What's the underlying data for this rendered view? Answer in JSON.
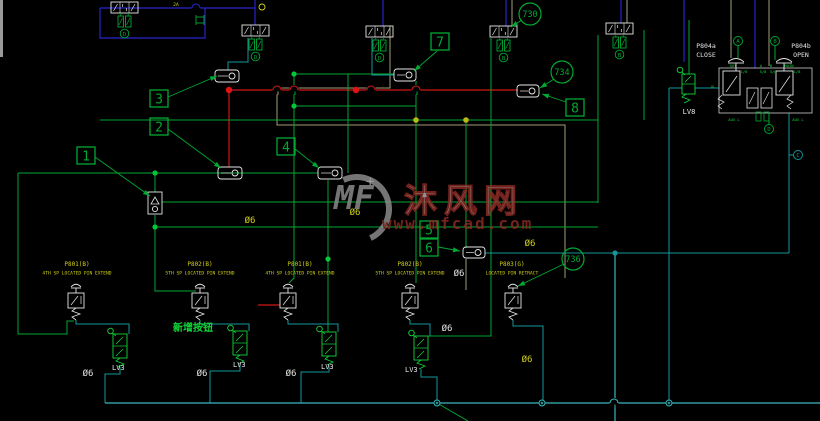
{
  "app": {
    "type": "cad-pneumatic-schematic",
    "background": "#000000"
  },
  "watermark": {
    "logo_text": "MF",
    "plus": "+",
    "site_name": "沐风网",
    "site_url": "www.mfcad.com"
  },
  "colors": {
    "green": "#00a833",
    "bright_green": "#12d63a",
    "teal": "#13969c",
    "cyan": "#38b8be",
    "blue": "#2626cc",
    "red": "#cf1616",
    "tan": "#a39d78",
    "yellow": "#d2d21a",
    "white": "#e6e6e6",
    "grey": "#9a9a9a",
    "maroon": "#8e2a22",
    "olive": "#b8b814"
  },
  "diagram": {
    "valves53": [
      {
        "cx": 124.5,
        "top": 2,
        "letter": "D"
      },
      {
        "cx": 255.5,
        "top": 25,
        "letter": "D"
      },
      {
        "cx": 379.5,
        "top": 26,
        "letter": "D"
      },
      {
        "cx": 503.5,
        "top": 26,
        "letter": "B"
      },
      {
        "cx": 619.5,
        "top": 23,
        "letter": "B"
      }
    ],
    "pushbuttons": [
      {
        "cx": 76
      },
      {
        "cx": 200
      },
      {
        "cx": 288
      },
      {
        "cx": 410
      },
      {
        "cx": 513
      }
    ],
    "lv_valves": [
      {
        "cx": 120,
        "top": 334,
        "label": "LV3",
        "lx": 112,
        "ly": 370
      },
      {
        "cx": 240,
        "top": 331,
        "label": "LV3",
        "lx": 233,
        "ly": 367
      },
      {
        "cx": 329,
        "top": 332,
        "label": "LV3",
        "lx": 321,
        "ly": 369
      },
      {
        "cx": 421,
        "top": 336,
        "label": "LV3",
        "lx": 405,
        "ly": 372
      }
    ],
    "lv8": {
      "x": 682,
      "y": 74,
      "label": "LV8",
      "lx": 682,
      "ly": 114
    },
    "check_valve": {
      "x": 148,
      "y": 192
    },
    "inline_components": [
      {
        "x": 215,
        "y": 70,
        "w": 24,
        "h": 12
      },
      {
        "x": 218,
        "y": 167,
        "w": 24,
        "h": 12
      },
      {
        "x": 318,
        "y": 167,
        "w": 24,
        "h": 12
      },
      {
        "x": 394,
        "y": 69,
        "w": 22,
        "h": 12
      },
      {
        "x": 517,
        "y": 85,
        "w": 22,
        "h": 12
      },
      {
        "x": 463,
        "y": 247,
        "w": 22,
        "h": 11
      }
    ],
    "assembly": {
      "rect": [
        719,
        68,
        93,
        45
      ],
      "left_code": "P804a",
      "left_state": "CLOSE",
      "right_code": "P804b",
      "right_state": "OPEN",
      "code_left_x": 706,
      "code_right_x": 801,
      "port_labels": [
        {
          "t": "OUT",
          "x": 733,
          "y": 67
        },
        {
          "t": "A",
          "x": 761,
          "y": 67
        },
        {
          "t": "B",
          "x": 771,
          "y": 67
        },
        {
          "t": "MAIN",
          "x": 789,
          "y": 67
        },
        {
          "t": "1/8",
          "x": 744,
          "y": 73
        },
        {
          "t": "5/8",
          "x": 763,
          "y": 73
        },
        {
          "t": "3/8",
          "x": 773,
          "y": 73
        },
        {
          "t": "1/8",
          "x": 797,
          "y": 73
        },
        {
          "t": "GL",
          "x": 713,
          "y": 88
        },
        {
          "t": "AUX L",
          "x": 734,
          "y": 121
        },
        {
          "t": "AUX L",
          "x": 798,
          "y": 121
        }
      ]
    },
    "port_circles": [
      {
        "letter": "A",
        "x": 738,
        "y": 41,
        "c": "green"
      },
      {
        "letter": "B",
        "x": 775,
        "y": 41,
        "c": "green"
      },
      {
        "letter": "D",
        "x": 769,
        "y": 129,
        "c": "green"
      },
      {
        "letter": "C",
        "x": 798,
        "y": 155,
        "c": "teal"
      }
    ],
    "stations": [
      {
        "code": "P801(B)",
        "desc": "4TH SP LOCATED PIN EXTEND",
        "x": 77
      },
      {
        "code": "P802(B)",
        "desc": "5TH SP LOCATED PIN EXTEND",
        "x": 200
      },
      {
        "code": "P801(B)",
        "desc": "4TH SP LOCATED PIN EXTEND",
        "x": 300
      },
      {
        "code": "P802(B)",
        "desc": "5TH SP LOCATED PIN EXTEND",
        "x": 410
      },
      {
        "code": "P803(G)",
        "desc": "LOCATED PIN RETRACT",
        "x": 512
      }
    ],
    "note": {
      "text": "新增按钮",
      "x": 193,
      "y": 331
    },
    "tiny_texts": [
      {
        "t": "2A",
        "x": 176,
        "y": 6
      }
    ],
    "diam_labels": [
      {
        "t": "Ø6",
        "x": 250,
        "y": 223,
        "c": "yellow"
      },
      {
        "t": "Ø6",
        "x": 355,
        "y": 215,
        "c": "yellow"
      },
      {
        "t": "Ø6",
        "x": 530,
        "y": 246,
        "c": "yellow"
      },
      {
        "t": "Ø6",
        "x": 527,
        "y": 362,
        "c": "yellow"
      },
      {
        "t": "Ø6",
        "x": 459,
        "y": 276,
        "c": "white"
      },
      {
        "t": "Ø6",
        "x": 88,
        "y": 376,
        "c": "white"
      },
      {
        "t": "Ø6",
        "x": 202,
        "y": 376,
        "c": "white"
      },
      {
        "t": "Ø6",
        "x": 291,
        "y": 376,
        "c": "white"
      },
      {
        "t": "Ø6",
        "x": 447,
        "y": 331,
        "c": "white"
      }
    ],
    "callout_squares": [
      {
        "n": "1",
        "x": 77,
        "y": 147,
        "lead": [
          [
            95,
            157
          ],
          [
            150,
            196
          ]
        ]
      },
      {
        "n": "2",
        "x": 150,
        "y": 118,
        "lead": [
          [
            168,
            129
          ],
          [
            221,
            168
          ]
        ]
      },
      {
        "n": "3",
        "x": 150,
        "y": 90,
        "lead": [
          [
            168,
            97
          ],
          [
            217,
            76
          ]
        ]
      },
      {
        "n": "4",
        "x": 277,
        "y": 138,
        "lead": [
          [
            295,
            149
          ],
          [
            319,
            168
          ]
        ]
      },
      {
        "n": "5",
        "x": 420,
        "y": 221,
        "lead": null
      },
      {
        "n": "6",
        "x": 420,
        "y": 239,
        "lead": [
          [
            438,
            247
          ],
          [
            460,
            251
          ]
        ]
      },
      {
        "n": "7",
        "x": 431,
        "y": 33,
        "lead": [
          [
            437,
            51
          ],
          [
            414,
            71
          ]
        ]
      },
      {
        "n": "8",
        "x": 566,
        "y": 99,
        "lead": [
          [
            566,
            102
          ],
          [
            542,
            94
          ]
        ]
      }
    ],
    "callout_circles": [
      {
        "n": "730",
        "x": 530,
        "y": 14,
        "lead": [
          [
            522,
            20
          ],
          [
            511,
            27
          ]
        ]
      },
      {
        "n": "734",
        "x": 562,
        "y": 72,
        "lead": [
          [
            554,
            79
          ],
          [
            540,
            88
          ]
        ]
      },
      {
        "n": "736",
        "x": 573,
        "y": 259,
        "lead": [
          [
            564,
            264
          ],
          [
            518,
            286
          ]
        ]
      }
    ],
    "wires": {
      "tan": [
        [
          [
            390,
            26
          ],
          [
            390,
            88
          ],
          [
            277,
            88
          ],
          [
            277,
            125
          ],
          [
            565,
            125
          ],
          [
            565,
            278
          ]
        ],
        [
          [
            512,
            0
          ],
          [
            512,
            26
          ]
        ],
        [
          [
            627,
            0
          ],
          [
            627,
            23
          ]
        ],
        [
          [
            731,
            0
          ],
          [
            731,
            58
          ]
        ],
        [
          [
            769,
            0
          ],
          [
            769,
            66
          ]
        ],
        [
          [
            466,
            259
          ],
          [
            466,
            290
          ]
        ]
      ],
      "blue": [
        [
          [
            100,
            8
          ],
          [
            100,
            38
          ],
          [
            205,
            38
          ],
          [
            205,
            8
          ]
        ],
        [
          [
            100,
            8
          ],
          [
            255,
            8
          ]
        ],
        [
          [
            255,
            0
          ],
          [
            255,
            25
          ]
        ],
        [
          [
            383,
            0
          ],
          [
            383,
            26
          ]
        ],
        [
          [
            506,
            0
          ],
          [
            506,
            26
          ]
        ],
        [
          [
            621,
            0
          ],
          [
            621,
            23
          ]
        ],
        [
          [
            684,
            0
          ],
          [
            684,
            62
          ]
        ],
        [
          [
            755,
            0
          ],
          [
            755,
            68
          ]
        ]
      ],
      "red": [
        [
          [
            229,
            90
          ],
          [
            229,
            167
          ]
        ],
        [
          [
            229,
            90
          ],
          [
            518,
            90
          ]
        ],
        [
          [
            258,
            305
          ],
          [
            280,
            305
          ]
        ]
      ],
      "green": [
        [
          [
            294,
            74
          ],
          [
            294,
            278
          ],
          [
            289,
            283
          ]
        ],
        [
          [
            348,
            74
          ],
          [
            348,
            173
          ]
        ],
        [
          [
            416,
            81
          ],
          [
            416,
            283
          ]
        ],
        [
          [
            466,
            120
          ],
          [
            466,
            248
          ]
        ],
        [
          [
            491,
            38
          ],
          [
            491,
            336
          ],
          [
            428,
            336
          ]
        ],
        [
          [
            328,
            180
          ],
          [
            328,
            332
          ]
        ],
        [
          [
            294,
            74
          ],
          [
            394,
            74
          ]
        ],
        [
          [
            294,
            106
          ],
          [
            416,
            106
          ]
        ],
        [
          [
            100,
            120
          ],
          [
            598,
            120
          ]
        ],
        [
          [
            18,
            173
          ],
          [
            318,
            173
          ]
        ],
        [
          [
            162,
            202
          ],
          [
            598,
            202
          ]
        ],
        [
          [
            155,
            227
          ],
          [
            598,
            227
          ]
        ],
        [
          [
            155,
            173
          ],
          [
            155,
            192
          ]
        ],
        [
          [
            155,
            215
          ],
          [
            155,
            291
          ],
          [
            196,
            291
          ]
        ],
        [
          [
            18,
            173
          ],
          [
            18,
            334
          ],
          [
            67,
            334
          ],
          [
            67,
            321
          ],
          [
            74,
            321
          ]
        ],
        [
          [
            598,
            35
          ],
          [
            598,
            203
          ]
        ],
        [
          [
            644,
            30
          ],
          [
            644,
            120
          ]
        ],
        [
          [
            689,
            20
          ],
          [
            689,
            74
          ]
        ],
        [
          [
            437,
            403
          ],
          [
            468,
            421
          ]
        ],
        [
          [
            738,
            45
          ],
          [
            738,
            58
          ]
        ],
        [
          [
            775,
            45
          ],
          [
            775,
            60
          ]
        ],
        [
          [
            769,
            124
          ],
          [
            769,
            113
          ]
        ]
      ],
      "teal": [
        [
          [
            248,
            38
          ],
          [
            248,
            62
          ],
          [
            228,
            62
          ],
          [
            228,
            70
          ]
        ],
        [
          [
            372,
            38
          ],
          [
            372,
            75
          ],
          [
            394,
            75
          ]
        ],
        [
          [
            669,
            88
          ],
          [
            682,
            88
          ]
        ],
        [
          [
            695,
            88
          ],
          [
            719,
            88
          ]
        ],
        [
          [
            669,
            88
          ],
          [
            669,
            403
          ]
        ],
        [
          [
            789,
            113
          ],
          [
            789,
            253
          ]
        ],
        [
          [
            485,
            253
          ],
          [
            789,
            253
          ]
        ],
        [
          [
            789,
            155
          ],
          [
            793,
            155
          ]
        ],
        [
          [
            76,
            320
          ],
          [
            76,
            324
          ],
          [
            129,
            324
          ],
          [
            129,
            334
          ]
        ],
        [
          [
            120,
            367
          ],
          [
            120,
            374
          ],
          [
            105,
            374
          ],
          [
            105,
            403
          ]
        ],
        [
          [
            200,
            320
          ],
          [
            200,
            324
          ],
          [
            249,
            324
          ],
          [
            249,
            331
          ]
        ],
        [
          [
            240,
            364
          ],
          [
            240,
            371
          ],
          [
            210,
            371
          ],
          [
            210,
            403
          ]
        ],
        [
          [
            288,
            320
          ],
          [
            288,
            324
          ],
          [
            338,
            324
          ],
          [
            338,
            332
          ]
        ],
        [
          [
            329,
            365
          ],
          [
            329,
            372
          ],
          [
            301,
            372
          ],
          [
            301,
            403
          ]
        ],
        [
          [
            410,
            320
          ],
          [
            410,
            324
          ],
          [
            430,
            324
          ],
          [
            430,
            336
          ]
        ],
        [
          [
            421,
            369
          ],
          [
            421,
            377
          ],
          [
            437,
            377
          ],
          [
            437,
            403
          ]
        ],
        [
          [
            513,
            320
          ],
          [
            513,
            326
          ],
          [
            543,
            326
          ],
          [
            543,
            403
          ]
        ]
      ],
      "cyan": [
        [
          [
            615,
            253
          ],
          [
            615,
            421
          ]
        ],
        [
          [
            105,
            403
          ],
          [
            820,
            403
          ]
        ]
      ]
    },
    "hops": [
      {
        "x": 196,
        "y": 8,
        "c": "blue"
      },
      {
        "x": 277,
        "y": 90,
        "c": "red",
        "u": "tan"
      },
      {
        "x": 294,
        "y": 90,
        "c": "red",
        "u": "green"
      },
      {
        "x": 371,
        "y": 90,
        "c": "red"
      },
      {
        "x": 416,
        "y": 90,
        "c": "red",
        "u": "green"
      },
      {
        "x": 614,
        "y": 403,
        "c": "cyan",
        "u": "cyan"
      }
    ],
    "dots": {
      "red": [
        [
          229,
          90
        ],
        [
          356,
          90
        ]
      ],
      "olive": [
        [
          416,
          120
        ],
        [
          466,
          120
        ]
      ],
      "green": [
        [
          155,
          173
        ],
        [
          155,
          227
        ],
        [
          294,
          74
        ],
        [
          294,
          106
        ],
        [
          328,
          259
        ]
      ],
      "teal": [
        [
          615,
          253
        ]
      ],
      "bus": [
        [
          437,
          403
        ],
        [
          542,
          403
        ],
        [
          669,
          403
        ]
      ],
      "yellow_ring": [
        [
          262,
          7
        ]
      ]
    }
  }
}
